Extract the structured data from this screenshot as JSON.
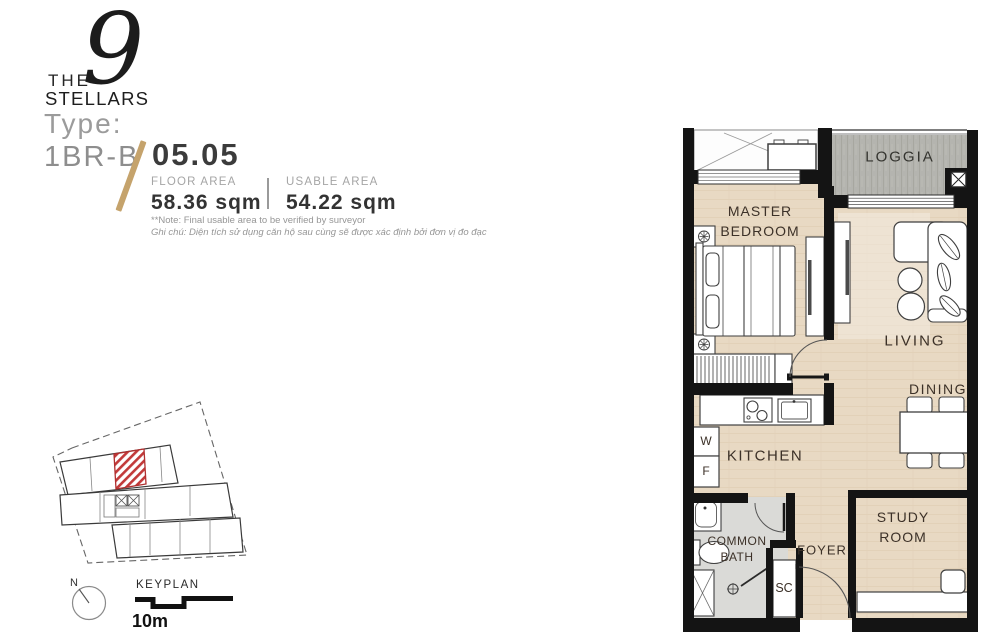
{
  "header": {
    "the": "THE",
    "nine": "9",
    "stellars": "STELLARS",
    "type_label": "Type:",
    "type_value": "1BR-B",
    "unit_number": "05.05",
    "floor_area_label": "FLOOR AREA",
    "floor_area_value": "58.36 sqm",
    "usable_area_label": "USABLE AREA",
    "usable_area_value": "54.22 sqm",
    "note1": "**Note: Final usable area to be verified by surveyor",
    "note2": "Ghi chú: Diện tích sử dụng căn hộ sau cùng sẽ được xác định bởi đơn vị đo đạc"
  },
  "keyplan": {
    "title": "KEYPLAN",
    "north": "N",
    "scale": "10m",
    "highlight_color": "#c23a3a"
  },
  "floorplan": {
    "labels": {
      "loggia": "LOGGIA",
      "master1": "MASTER",
      "master2": "BEDROOM",
      "living": "LIVING",
      "dining": "DINING",
      "kitchen": "KITCHEN",
      "bath1": "COMMON",
      "bath2": "BATH",
      "foyer": "FOYER",
      "study1": "STUDY",
      "study2": "ROOM",
      "sc": "SC",
      "washer": "W",
      "fridge": "F"
    }
  },
  "colors": {
    "accent_gold": "#c5a36c",
    "wall_black": "#141414",
    "floor_tan": "#e8d9c3",
    "loggia_gray": "#b4b4af",
    "bath_gray": "#dadad7",
    "keyplan_red": "#c23a3a"
  }
}
